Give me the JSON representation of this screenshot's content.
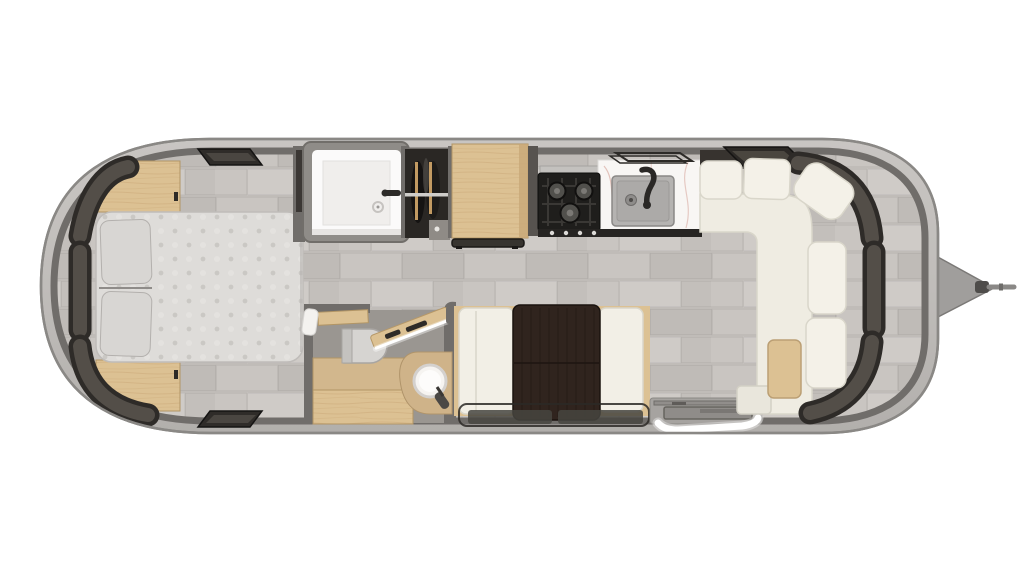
{
  "meta": {
    "type": "floor-plan",
    "subject": "Travel trailer floor plan, top-down rendered view, rear bedroom at left and front lounge with hitch at right",
    "visible_text": "none"
  },
  "palette": {
    "bg": "#ffffff",
    "shell": "#c1beba",
    "shell_line": "#8a8885",
    "wall": "#706d6a",
    "floor": "#c9c5c1",
    "tile_line": "#bab6b2",
    "window_outer": "#2e2b28",
    "window_inner": "#534e48",
    "wood": "#dcc193",
    "wood_line": "#b29565",
    "cream": "#f2efe6",
    "cream_line": "#d9d6ca",
    "mattress": "#dedcd9",
    "pillow": "#d8d6d3",
    "white": "#fbfafa",
    "marble": "#f8f6f4",
    "sink": "#b5b3b1",
    "stove": "#1f1e1c",
    "table": "#30241e",
    "bath_floor": "#9a9691",
    "metal": "#a6a3a0",
    "led": "#ffffff",
    "dark_fixture": "#3b3734",
    "hitch": "#a09e9c",
    "hitch_line": "#6e6c6a"
  },
  "fixtures": {
    "bedroom": [
      "queen-bed",
      "pillows",
      "nightstand-top",
      "nightstand-bottom",
      "wardrobe-cabinet-dark",
      "roof-vent-top",
      "roof-vent-bottom",
      "curved-windows"
    ],
    "wet_bath": [
      "shower-stall",
      "shower-drain",
      "shower-control"
    ],
    "closet": [
      "hanging-clothes",
      "closet-rod",
      "wood-hangers"
    ],
    "galley": [
      "wood-countertop-cabinet",
      "three-burner-stove",
      "range-hood",
      "kitchen-sink",
      "kitchen-faucet",
      "marble-counter",
      "roof-vent-outline"
    ],
    "bathroom": [
      "toilet",
      "vessel-sink",
      "vanity",
      "open-pocket-door-with-led",
      "towel"
    ],
    "dinette": [
      "bench-left",
      "bench-right",
      "espresso-table",
      "under-table-frame",
      "floor-mats"
    ],
    "lounge": [
      "l-shaped-sofa",
      "back-cushions",
      "corner-cushion",
      "coffee-table",
      "sofa-step",
      "roof-vent-front"
    ],
    "entry": [
      "entry-step-platform",
      "white-grab-rail"
    ],
    "exterior": [
      "aluminum-shell",
      "a-frame-hitch",
      "hitch-coupler"
    ]
  }
}
